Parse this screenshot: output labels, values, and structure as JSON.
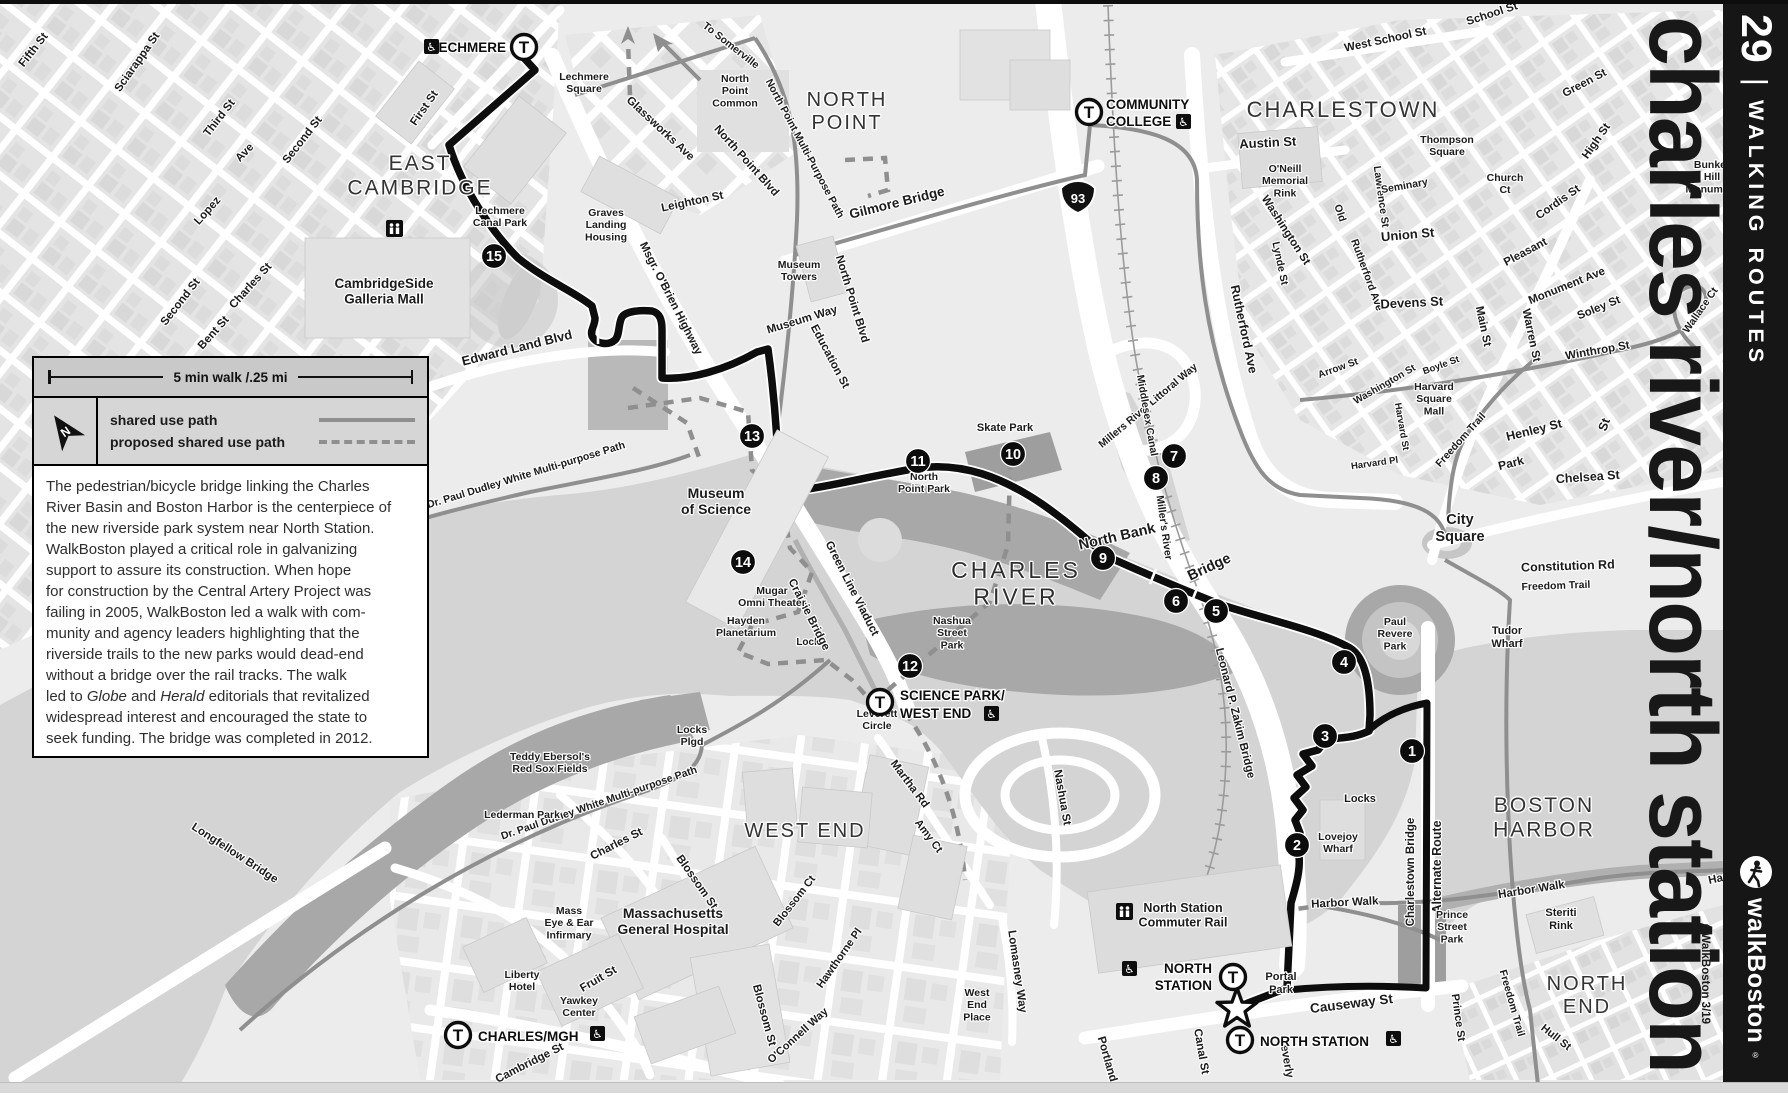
{
  "map_title": "charles river/north station",
  "credit": "©WalkBoston 3/19",
  "sidebar": {
    "route_number": "29",
    "divider": "|",
    "title": "WALKING ROUTES",
    "brand": "walkBoston",
    "brand_reg": "®"
  },
  "legend": {
    "scale_label": "5 min walk /.25 mi",
    "north_label": "N",
    "items": [
      {
        "label": "shared use path",
        "style": "solid"
      },
      {
        "label": "proposed shared use path",
        "style": "dashed"
      }
    ]
  },
  "description": {
    "lines": [
      "The pedestrian/bicycle bridge linking the Charles",
      "River Basin and Boston Harbor is the centerpiece of",
      "the new riverside park system near North Station.",
      "WalkBoston played a critical role in galvanizing",
      "support to assure its construction. When hope",
      "for construction by the Central Artery Project was",
      "failing in 2005, WalkBoston led a walk with com-",
      "munity and agency leaders highlighting that the",
      "riverside trails to the new parks would dead-end",
      "without a bridge over the rail tracks. The walk",
      "led to Globe and Herald editorials that revitalized",
      "widespread interest and encouraged the state to",
      "seek funding. The bridge was completed in 2012."
    ],
    "italic_words": [
      "Globe",
      "Herald"
    ]
  },
  "markers": {
    "star": {
      "x": 1237,
      "y": 1009
    },
    "interstate_shield": {
      "label": "93",
      "x": 1078,
      "y": 196
    },
    "mall_icon": {
      "x": 386,
      "y": 220
    },
    "commuter_rail_icon": {
      "x": 1116,
      "y": 903
    }
  },
  "waypoints": [
    {
      "n": 1,
      "x": 1412,
      "y": 751
    },
    {
      "n": 2,
      "x": 1297,
      "y": 845
    },
    {
      "n": 3,
      "x": 1325,
      "y": 736
    },
    {
      "n": 4,
      "x": 1344,
      "y": 662
    },
    {
      "n": 5,
      "x": 1216,
      "y": 611
    },
    {
      "n": 6,
      "x": 1176,
      "y": 601
    },
    {
      "n": 7,
      "x": 1174,
      "y": 456
    },
    {
      "n": 8,
      "x": 1156,
      "y": 478
    },
    {
      "n": 9,
      "x": 1103,
      "y": 558
    },
    {
      "n": 10,
      "x": 1013,
      "y": 454
    },
    {
      "n": 11,
      "x": 918,
      "y": 461
    },
    {
      "n": 12,
      "x": 910,
      "y": 666
    },
    {
      "n": 13,
      "x": 752,
      "y": 436
    },
    {
      "n": 14,
      "x": 743,
      "y": 562
    },
    {
      "n": 15,
      "x": 494,
      "y": 256
    }
  ],
  "stations": [
    {
      "name": "LECHMERE",
      "cx": 524,
      "cy": 47,
      "labels": [
        {
          "t": "LECHMERE",
          "x": 506,
          "y": 52,
          "anchor": "end"
        }
      ],
      "icon": {
        "x": 424,
        "y": 39
      }
    },
    {
      "name": "COMMUNITY COLLEGE",
      "cx": 1089,
      "cy": 112,
      "labels": [
        {
          "t": "COMMUNITY",
          "x": 1106,
          "y": 109,
          "anchor": "start"
        },
        {
          "t": "COLLEGE",
          "x": 1106,
          "y": 126,
          "anchor": "start"
        }
      ],
      "icon": {
        "x": 1176,
        "y": 114
      }
    },
    {
      "name": "SCIENCE PARK/WEST END",
      "cx": 880,
      "cy": 702,
      "labels": [
        {
          "t": "SCIENCE PARK/",
          "x": 900,
          "y": 700,
          "anchor": "start"
        },
        {
          "t": "WEST END",
          "x": 900,
          "y": 718,
          "anchor": "start"
        }
      ],
      "icon": {
        "x": 984,
        "y": 706
      }
    },
    {
      "name": "CHARLES/MGH",
      "cx": 458,
      "cy": 1035,
      "labels": [
        {
          "t": "CHARLES/MGH",
          "x": 478,
          "y": 1041,
          "anchor": "start"
        }
      ],
      "icon": {
        "x": 590,
        "y": 1026
      }
    },
    {
      "name": "NORTH STATION",
      "cx": 1233,
      "cy": 977,
      "labels": [
        {
          "t": "NORTH",
          "x": 1212,
          "y": 973,
          "anchor": "end"
        },
        {
          "t": "STATION",
          "x": 1212,
          "y": 990,
          "anchor": "end"
        }
      ],
      "icon": {
        "x": 1122,
        "y": 961
      }
    },
    {
      "name": "NORTH STATION",
      "cx": 1240,
      "cy": 1040,
      "labels": [
        {
          "t": "NORTH STATION",
          "x": 1260,
          "y": 1046,
          "anchor": "start"
        }
      ],
      "icon": {
        "x": 1386,
        "y": 1031
      }
    }
  ],
  "labels": [
    {
      "t": "Fifth St",
      "x": 36,
      "y": 52,
      "r": -52
    },
    {
      "t": "Sciarappa St",
      "x": 140,
      "y": 64,
      "r": -55
    },
    {
      "t": "Third St",
      "x": 222,
      "y": 120,
      "r": -52
    },
    {
      "t": "Second St",
      "x": 305,
      "y": 142,
      "r": -52
    },
    {
      "t": "Ave",
      "x": 247,
      "y": 155,
      "r": -46
    },
    {
      "t": "Lopez",
      "x": 210,
      "y": 213,
      "r": -48
    },
    {
      "t": "Second St",
      "x": 183,
      "y": 304,
      "r": -52
    },
    {
      "t": "Charles St",
      "x": 253,
      "y": 288,
      "r": -48
    },
    {
      "t": "Bent St",
      "x": 216,
      "y": 335,
      "r": -48
    },
    {
      "t": "First St",
      "x": 427,
      "y": 110,
      "r": -55
    },
    {
      "t": "Edward Land Blvd",
      "x": 518,
      "y": 352,
      "r": -14,
      "s": 13
    },
    {
      "lines": [
        "EAST",
        "CAMBRIDGE"
      ],
      "x": 420,
      "y": 170,
      "cls": "area",
      "s": 21
    },
    {
      "lines": [
        "Lechmere",
        "Canal Park"
      ],
      "x": 500,
      "y": 214,
      "cls": "place"
    },
    {
      "lines": [
        "CambridgeSide",
        "Galleria Mall"
      ],
      "x": 384,
      "y": 288,
      "cls": "place",
      "s": 13.5
    },
    {
      "lines": [
        "Lechmere",
        "Square"
      ],
      "x": 584,
      "y": 80,
      "cls": "place"
    },
    {
      "lines": [
        "Graves",
        "Landing",
        "Housing"
      ],
      "x": 606,
      "y": 216,
      "cls": "place"
    },
    {
      "t": "Glassworks Ave",
      "x": 658,
      "y": 131,
      "r": 43
    },
    {
      "t": "North Point Blvd",
      "x": 744,
      "y": 163,
      "r": 48
    },
    {
      "t": "North Point Blvd",
      "x": 849,
      "y": 300,
      "r": 73
    },
    {
      "t": "Leighton St",
      "x": 693,
      "y": 205,
      "r": -12
    },
    {
      "t": "Msgr. O'Brien Highway",
      "x": 668,
      "y": 300,
      "r": 63
    },
    {
      "lines": [
        "North",
        "Point",
        "Common"
      ],
      "x": 735,
      "y": 82,
      "cls": "place"
    },
    {
      "lines": [
        "NORTH",
        "POINT"
      ],
      "x": 847,
      "y": 106,
      "cls": "area",
      "s": 20
    },
    {
      "t": "To Somerville",
      "x": 729,
      "y": 48,
      "r": 38,
      "s": 10.5
    },
    {
      "t": "North Point Multi-Purpose Path",
      "x": 802,
      "y": 150,
      "r": 62,
      "s": 10.5
    },
    {
      "t": "Gilmore Bridge",
      "x": 898,
      "y": 207,
      "r": -14,
      "s": 13.5
    },
    {
      "lines": [
        "Museum",
        "Towers"
      ],
      "x": 799,
      "y": 268,
      "cls": "place"
    },
    {
      "t": "Museum Way",
      "x": 803,
      "y": 323,
      "r": -17
    },
    {
      "t": "Education St",
      "x": 827,
      "y": 358,
      "r": 62
    },
    {
      "t": "West School St",
      "x": 1386,
      "y": 43,
      "r": -12
    },
    {
      "t": "School St",
      "x": 1493,
      "y": 17,
      "r": -18
    },
    {
      "t": "CHARLESTOWN",
      "x": 1343,
      "y": 117,
      "cls": "area",
      "s": 22
    },
    {
      "t": "Austin St",
      "x": 1268,
      "y": 147,
      "r": -3,
      "s": 13
    },
    {
      "lines": [
        "O'Neill",
        "Memorial",
        "Rink"
      ],
      "x": 1285,
      "y": 172,
      "cls": "place"
    },
    {
      "t": "Washington St",
      "x": 1283,
      "y": 232,
      "r": 57
    },
    {
      "t": "Lynde St",
      "x": 1277,
      "y": 264,
      "r": 78,
      "s": 10.5
    },
    {
      "t": "Old",
      "x": 1337,
      "y": 214,
      "r": 72,
      "s": 10.5
    },
    {
      "t": "Rutherford Ave",
      "x": 1364,
      "y": 276,
      "r": 70,
      "s": 10.5
    },
    {
      "t": "Lawrence St",
      "x": 1378,
      "y": 197,
      "r": 82,
      "s": 10.5
    },
    {
      "t": "Seminary",
      "x": 1405,
      "y": 189,
      "r": -10,
      "s": 10.5
    },
    {
      "t": "Union St",
      "x": 1408,
      "y": 239,
      "r": -5,
      "s": 13
    },
    {
      "t": "Devens St",
      "x": 1412,
      "y": 307,
      "r": -3,
      "s": 13
    },
    {
      "lines": [
        "Thompson",
        "Square"
      ],
      "x": 1447,
      "y": 143,
      "cls": "place"
    },
    {
      "lines": [
        "Church",
        "Ct"
      ],
      "x": 1505,
      "y": 181,
      "cls": "place"
    },
    {
      "t": "Green St",
      "x": 1586,
      "y": 86,
      "r": -28
    },
    {
      "t": "High St",
      "x": 1599,
      "y": 143,
      "r": -55
    },
    {
      "t": "Cordis St",
      "x": 1560,
      "y": 205,
      "r": -35
    },
    {
      "t": "Pleasant",
      "x": 1527,
      "y": 255,
      "r": -28
    },
    {
      "t": "Monument Ave",
      "x": 1568,
      "y": 289,
      "r": -22
    },
    {
      "t": "Soley St",
      "x": 1600,
      "y": 311,
      "r": -22
    },
    {
      "t": "Winthrop St",
      "x": 1598,
      "y": 354,
      "r": -10
    },
    {
      "t": "Warren St",
      "x": 1528,
      "y": 336,
      "r": 78
    },
    {
      "t": "Main St",
      "x": 1480,
      "y": 327,
      "r": 78
    },
    {
      "t": "Wallace Ct",
      "x": 1703,
      "y": 312,
      "r": -55,
      "s": 10.5
    },
    {
      "lines": [
        "Bunker",
        "Hill",
        "Monument"
      ],
      "x": 1712,
      "y": 168,
      "cls": "place"
    },
    {
      "lines": [
        "Harvard",
        "Square",
        "Mall"
      ],
      "x": 1434,
      "y": 390,
      "cls": "place"
    },
    {
      "t": "Harvard Pl",
      "x": 1375,
      "y": 466,
      "r": -8,
      "s": 9.5
    },
    {
      "t": "Harvard St",
      "x": 1399,
      "y": 427,
      "r": 80,
      "s": 9.5
    },
    {
      "t": "Freedom Trail",
      "x": 1463,
      "y": 442,
      "r": -48,
      "s": 10.5
    },
    {
      "t": "Boyle St",
      "x": 1442,
      "y": 368,
      "r": -20,
      "s": 9.5
    },
    {
      "t": "Henley St",
      "x": 1535,
      "y": 434,
      "r": -14,
      "s": 12.5
    },
    {
      "t": "St",
      "x": 1608,
      "y": 426,
      "r": -70,
      "s": 12.5
    },
    {
      "t": "Park",
      "x": 1512,
      "y": 467,
      "r": -14,
      "s": 12
    },
    {
      "t": "Arrow St",
      "x": 1339,
      "y": 371,
      "r": -20,
      "s": 10
    },
    {
      "t": "Washington St",
      "x": 1386,
      "y": 387,
      "r": -30,
      "s": 10
    },
    {
      "t": "Rutherford Ave",
      "x": 1240,
      "y": 330,
      "r": 78,
      "s": 12.5
    },
    {
      "t": "Millers River Littoral Way",
      "x": 1150,
      "y": 408,
      "r": -40,
      "s": 10.5
    },
    {
      "t": "Chelsea St",
      "x": 1588,
      "y": 481,
      "r": -4,
      "s": 12.5
    },
    {
      "lines": [
        "City",
        "Square"
      ],
      "x": 1460,
      "y": 524,
      "cls": "place",
      "s": 14.5
    },
    {
      "t": "Constitution Rd",
      "x": 1568,
      "y": 570,
      "r": -2,
      "s": 12.5
    },
    {
      "t": "Freedom Trail",
      "x": 1556,
      "y": 589,
      "r": -2,
      "s": 10.5,
      "w": 400
    },
    {
      "lines": [
        "Tudor",
        "Wharf"
      ],
      "x": 1507,
      "y": 634,
      "cls": "place",
      "s": 11
    },
    {
      "t": "Middlesex Canal",
      "x": 1144,
      "y": 416,
      "r": 80,
      "s": 10.5
    },
    {
      "t": "Miller's River",
      "x": 1161,
      "y": 528,
      "r": 82,
      "s": 10.5
    },
    {
      "t": "Leonard P. Zakim Bridge",
      "x": 1232,
      "y": 714,
      "r": 76,
      "s": 11.5
    },
    {
      "t": "North Bank",
      "x": 1118,
      "y": 541,
      "r": -13,
      "s": 14.5
    },
    {
      "t": "Bridge",
      "x": 1211,
      "y": 571,
      "r": -25,
      "s": 14.5
    },
    {
      "lines": [
        "CHARLES",
        "RIVER"
      ],
      "x": 1016,
      "y": 578,
      "cls": "water",
      "s": 23
    },
    {
      "lines": [
        "North",
        "Point Park"
      ],
      "x": 924,
      "y": 480,
      "cls": "place"
    },
    {
      "t": "Skate Park",
      "x": 1005,
      "y": 431,
      "cls": "place",
      "s": 11
    },
    {
      "lines": [
        "Nashua",
        "Street",
        "Park"
      ],
      "x": 952,
      "y": 624,
      "cls": "place"
    },
    {
      "lines": [
        "Paul",
        "Revere",
        "Park"
      ],
      "x": 1395,
      "y": 625,
      "cls": "place"
    },
    {
      "lines": [
        "Lovejoy",
        "Wharf"
      ],
      "x": 1338,
      "y": 840,
      "cls": "place"
    },
    {
      "t": "Locks",
      "x": 1360,
      "y": 802,
      "cls": "place",
      "s": 11
    },
    {
      "t": "Lock",
      "x": 808,
      "y": 645,
      "cls": "place",
      "s": 10
    },
    {
      "t": "Harbor Walk",
      "x": 1345,
      "y": 906,
      "r": -3,
      "s": 11.5
    },
    {
      "t": "Harbor Walk",
      "x": 1532,
      "y": 893,
      "r": -9,
      "s": 11.5
    },
    {
      "t": "Harbor Walk",
      "x": 1742,
      "y": 877,
      "r": -12,
      "s": 11.5
    },
    {
      "lines": [
        "BOSTON",
        "HARBOR"
      ],
      "x": 1544,
      "y": 812,
      "cls": "area",
      "s": 21
    },
    {
      "t": "Charlestown Bridge",
      "x": 1414,
      "y": 872,
      "r": -90,
      "s": 11.5
    },
    {
      "t": "Alternate Route",
      "x": 1441,
      "y": 867,
      "r": -90,
      "s": 12.5
    },
    {
      "lines": [
        "Prince",
        "Street",
        "Park"
      ],
      "x": 1452,
      "y": 918,
      "cls": "place"
    },
    {
      "t": "Prince St",
      "x": 1455,
      "y": 1018,
      "r": 82,
      "s": 11
    },
    {
      "t": "Freedom Trail",
      "x": 1509,
      "y": 1004,
      "r": 74,
      "s": 10.5
    },
    {
      "lines": [
        "NORTH",
        "END"
      ],
      "x": 1587,
      "y": 990,
      "cls": "area",
      "s": 20
    },
    {
      "lines": [
        "Steriti",
        "Rink"
      ],
      "x": 1561,
      "y": 916,
      "cls": "place",
      "s": 11
    },
    {
      "t": "Hull St",
      "x": 1554,
      "y": 1040,
      "r": 38,
      "s": 11
    },
    {
      "t": "Causeway St",
      "x": 1352,
      "y": 1008,
      "r": -7,
      "s": 13.5
    },
    {
      "t": "Canal St",
      "x": 1198,
      "y": 1052,
      "r": 80,
      "s": 11.5
    },
    {
      "t": "Beverly",
      "x": 1283,
      "y": 1058,
      "r": 80,
      "s": 11.5
    },
    {
      "t": "Portland",
      "x": 1104,
      "y": 1060,
      "r": 74,
      "s": 11.5
    },
    {
      "lines": [
        "Portal",
        "Park"
      ],
      "x": 1281,
      "y": 980,
      "cls": "place",
      "s": 11
    },
    {
      "lines": [
        "North Station",
        "Commuter Rail"
      ],
      "x": 1183,
      "y": 912,
      "cls": "place",
      "s": 12.5
    },
    {
      "t": "Nashua St",
      "x": 1059,
      "y": 798,
      "r": 80,
      "s": 11.5
    },
    {
      "t": "Lomasney Way",
      "x": 1014,
      "y": 972,
      "r": 82,
      "s": 11.5
    },
    {
      "lines": [
        "West",
        "End",
        "Place"
      ],
      "x": 977,
      "y": 996,
      "cls": "place"
    },
    {
      "t": "Green Line Viaduct",
      "x": 849,
      "y": 590,
      "r": 63,
      "s": 11.5
    },
    {
      "t": "Craigie Bridge",
      "x": 806,
      "y": 616,
      "r": 63,
      "s": 11.5
    },
    {
      "lines": [
        "Museum",
        "of Science"
      ],
      "x": 716,
      "y": 498,
      "cls": "place",
      "s": 14
    },
    {
      "lines": [
        "Mugar",
        "Omni Theater"
      ],
      "x": 772,
      "y": 594,
      "cls": "place"
    },
    {
      "lines": [
        "Hayden",
        "Planetarium"
      ],
      "x": 746,
      "y": 624,
      "cls": "place"
    },
    {
      "t": "Dr. Paul Dudley White Multi-purpose Path",
      "x": 527,
      "y": 478,
      "r": -17,
      "s": 10.5
    },
    {
      "t": "Dr. Paul Dudley White Multi-purpose Path",
      "x": 600,
      "y": 806,
      "r": -19,
      "s": 10.5
    },
    {
      "lines": [
        "Locks",
        "Plgd"
      ],
      "x": 692,
      "y": 733,
      "cls": "place"
    },
    {
      "lines": [
        "Leverett",
        "Circle"
      ],
      "x": 877,
      "y": 717,
      "cls": "place"
    },
    {
      "t": "WEST END",
      "x": 805,
      "y": 837,
      "cls": "area",
      "s": 20
    },
    {
      "t": "Martha Rd",
      "x": 907,
      "y": 786,
      "r": 53,
      "s": 11.5
    },
    {
      "t": "Amy Ct",
      "x": 926,
      "y": 838,
      "r": 53,
      "s": 11
    },
    {
      "t": "Blossom Ct",
      "x": 797,
      "y": 903,
      "r": -52,
      "s": 11
    },
    {
      "t": "Blossom St",
      "x": 694,
      "y": 884,
      "r": 55,
      "s": 11.5
    },
    {
      "t": "Blossom St",
      "x": 761,
      "y": 1016,
      "r": 75,
      "s": 11.5
    },
    {
      "t": "Hawthorne Pl",
      "x": 842,
      "y": 960,
      "r": -55,
      "s": 11
    },
    {
      "t": "O'Connell Way",
      "x": 800,
      "y": 1038,
      "r": -42,
      "s": 11
    },
    {
      "t": "Fruit St",
      "x": 600,
      "y": 982,
      "r": -30,
      "s": 11.5
    },
    {
      "lines": [
        "Liberty",
        "Hotel"
      ],
      "x": 522,
      "y": 978,
      "cls": "place"
    },
    {
      "lines": [
        "Yawkey",
        "Center"
      ],
      "x": 579,
      "y": 1004,
      "cls": "place"
    },
    {
      "lines": [
        "Mass",
        "Eye & Ear",
        "Infirmary"
      ],
      "x": 569,
      "y": 914,
      "cls": "place"
    },
    {
      "lines": [
        "Massachusetts",
        "General Hospital"
      ],
      "x": 673,
      "y": 918,
      "cls": "place",
      "s": 14
    },
    {
      "t": "Charles St",
      "x": 618,
      "y": 847,
      "r": -27,
      "s": 11.5
    },
    {
      "t": "Cambridge St",
      "x": 531,
      "y": 1066,
      "r": -27,
      "s": 11.5
    },
    {
      "lines": [
        "Teddy Ebersol's",
        "Red Sox Fields"
      ],
      "x": 550,
      "y": 760,
      "cls": "place"
    },
    {
      "t": "Lederman Park",
      "x": 522,
      "y": 818,
      "cls": "place",
      "s": 10.5
    },
    {
      "t": "Longfellow Bridge",
      "x": 233,
      "y": 856,
      "r": 33,
      "s": 11.5
    }
  ]
}
